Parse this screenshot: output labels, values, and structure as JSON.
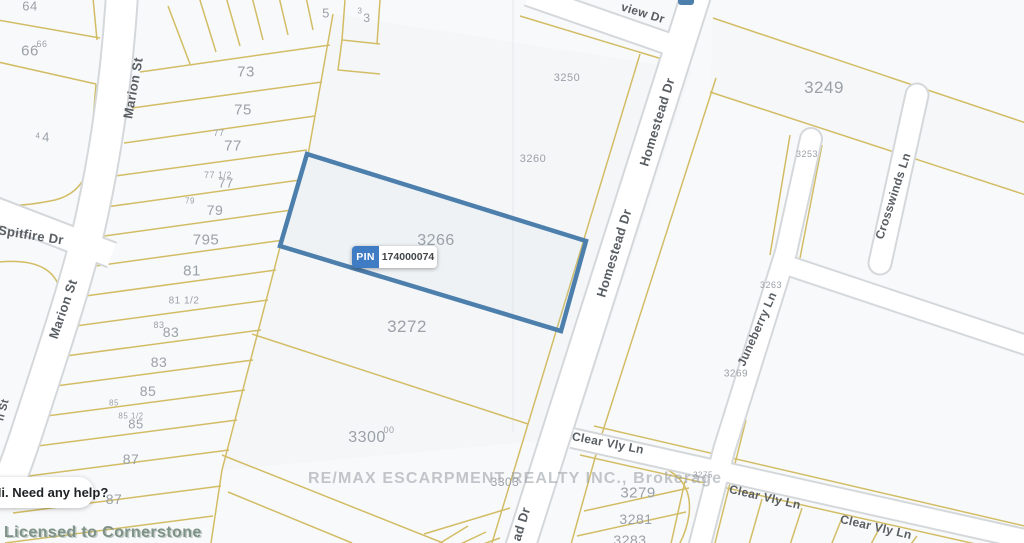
{
  "map": {
    "subject_parcel": {
      "pin_label": "PIN",
      "pin_value": "174000074"
    },
    "street_labels": [
      {
        "text": "Marion St",
        "x": 133,
        "y": 88,
        "rot": -80,
        "fs": 13
      },
      {
        "text": "Marion St",
        "x": 63,
        "y": 309,
        "rot": -71,
        "fs": 13
      },
      {
        "text": "n St",
        "x": 3,
        "y": 410,
        "rot": -75,
        "fs": 11
      },
      {
        "text": "Spitfire Dr",
        "x": 31,
        "y": 235,
        "rot": 9,
        "fs": 13
      },
      {
        "text": "view Dr",
        "x": 643,
        "y": 13,
        "rot": 17,
        "fs": 12
      },
      {
        "text": "Homestead Dr",
        "x": 657,
        "y": 122,
        "rot": -73,
        "fs": 13
      },
      {
        "text": "Homestead Dr",
        "x": 614,
        "y": 253,
        "rot": -73,
        "fs": 13
      },
      {
        "text": "ad Dr",
        "x": 521,
        "y": 524,
        "rot": -73,
        "fs": 13
      },
      {
        "text": "Clear Vly Ln",
        "x": 608,
        "y": 443,
        "rot": 11,
        "fs": 12
      },
      {
        "text": "Clear Vly Ln",
        "x": 765,
        "y": 497,
        "rot": 13,
        "fs": 12
      },
      {
        "text": "Clear Vly Ln",
        "x": 876,
        "y": 527,
        "rot": 13,
        "fs": 12
      },
      {
        "text": "Crosswinds Ln",
        "x": 893,
        "y": 196,
        "rot": -72,
        "fs": 12
      },
      {
        "text": "Juneberry Ln",
        "x": 757,
        "y": 329,
        "rot": -66,
        "fs": 12
      }
    ],
    "lot_labels": [
      {
        "text": "64",
        "x": 30,
        "y": 6,
        "fs": 13
      },
      {
        "text": "66",
        "x": 30,
        "y": 51,
        "fs": 15
      },
      {
        "text": "66",
        "x": 42,
        "y": 44,
        "fs": 9
      },
      {
        "text": "4",
        "x": 46,
        "y": 137,
        "fs": 13
      },
      {
        "text": "4",
        "x": 38,
        "y": 136,
        "fs": 8
      },
      {
        "text": "5",
        "x": 326,
        "y": 13,
        "fs": 13
      },
      {
        "text": "3",
        "x": 367,
        "y": 18,
        "fs": 12
      },
      {
        "text": "3",
        "x": 360,
        "y": 11,
        "fs": 8
      },
      {
        "text": "73",
        "x": 246,
        "y": 72,
        "fs": 15
      },
      {
        "text": "75",
        "x": 243,
        "y": 110,
        "fs": 15
      },
      {
        "text": "77",
        "x": 219,
        "y": 133,
        "fs": 9
      },
      {
        "text": "77",
        "x": 233,
        "y": 146,
        "fs": 15
      },
      {
        "text": "77 1/2",
        "x": 218,
        "y": 175,
        "fs": 9
      },
      {
        "text": "77",
        "x": 226,
        "y": 183,
        "fs": 13
      },
      {
        "text": "79",
        "x": 190,
        "y": 201,
        "fs": 8
      },
      {
        "text": "79",
        "x": 215,
        "y": 210,
        "fs": 14
      },
      {
        "text": "795",
        "x": 206,
        "y": 240,
        "fs": 15
      },
      {
        "text": "81",
        "x": 192,
        "y": 271,
        "fs": 15
      },
      {
        "text": "81 1/2",
        "x": 184,
        "y": 301,
        "fs": 10
      },
      {
        "text": "83",
        "x": 159,
        "y": 325,
        "fs": 9
      },
      {
        "text": "83",
        "x": 171,
        "y": 332,
        "fs": 14
      },
      {
        "text": "83",
        "x": 159,
        "y": 362,
        "fs": 14
      },
      {
        "text": "85",
        "x": 148,
        "y": 391,
        "fs": 14
      },
      {
        "text": "85",
        "x": 114,
        "y": 403,
        "fs": 8
      },
      {
        "text": "85 1/2",
        "x": 131,
        "y": 416,
        "fs": 8
      },
      {
        "text": "85",
        "x": 136,
        "y": 424,
        "fs": 13
      },
      {
        "text": "87",
        "x": 131,
        "y": 459,
        "fs": 14
      },
      {
        "text": "87",
        "x": 114,
        "y": 499,
        "fs": 14
      },
      {
        "text": "3250",
        "x": 567,
        "y": 78,
        "fs": 11
      },
      {
        "text": "3260",
        "x": 533,
        "y": 159,
        "fs": 11
      },
      {
        "text": "3266",
        "x": 436,
        "y": 241,
        "fs": 16
      },
      {
        "text": "3272",
        "x": 407,
        "y": 327,
        "fs": 17
      },
      {
        "text": "3300",
        "x": 367,
        "y": 438,
        "fs": 16
      },
      {
        "text": "00",
        "x": 389,
        "y": 430,
        "fs": 9
      },
      {
        "text": "3303",
        "x": 505,
        "y": 482,
        "fs": 12
      },
      {
        "text": "3249",
        "x": 824,
        "y": 88,
        "fs": 17
      },
      {
        "text": "3253",
        "x": 807,
        "y": 154,
        "fs": 9
      },
      {
        "text": "3263",
        "x": 771,
        "y": 285,
        "fs": 9
      },
      {
        "text": "3269",
        "x": 736,
        "y": 374,
        "fs": 10
      },
      {
        "text": "3275",
        "x": 703,
        "y": 475,
        "fs": 8
      },
      {
        "text": "3279",
        "x": 638,
        "y": 493,
        "fs": 15
      },
      {
        "text": "3281",
        "x": 636,
        "y": 519,
        "fs": 14
      },
      {
        "text": "3283",
        "x": 630,
        "y": 540,
        "fs": 14
      }
    ],
    "watermarks": {
      "center": "RE/MAX ESCARPMENT REALTY INC., Brokerage",
      "bottom_left": "Licensed to Cornerstone"
    },
    "colors": {
      "parcel_line": "#d2bd66",
      "subject_outline": "#4d7fad",
      "pin_badge_blue": "#3f7cc4",
      "road_fill": "#ffffff",
      "road_casing": "#d5d8db",
      "lot_text": "#9aa1a8",
      "street_text": "#595e63",
      "background": "#f8f9fa"
    }
  },
  "chat_widget": {
    "message": "Hi. Need any help?"
  }
}
